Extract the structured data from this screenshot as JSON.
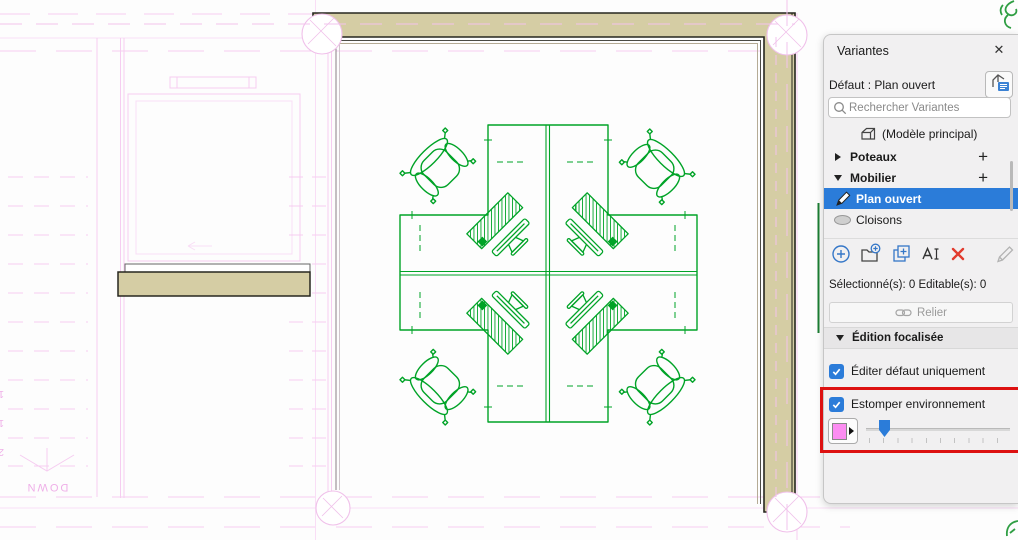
{
  "panel": {
    "title": "Variantes",
    "close_label": "✕",
    "default_line": "Défaut : Plan ouvert",
    "search_placeholder": "Rechercher Variantes",
    "main_model_label": "(Modèle principal)",
    "sets": [
      {
        "label": "Poteaux",
        "add_label": "+",
        "expanded": false
      },
      {
        "label": "Mobilier",
        "add_label": "+",
        "expanded": true
      }
    ],
    "options": [
      {
        "label": "Plan ouvert",
        "state": "selected-editing"
      },
      {
        "label": "Cloisons",
        "state": "hidden"
      }
    ],
    "status_line": "Sélectionné(s): 0 Editable(s): 0",
    "link_button_label": "Relier",
    "focused_edit_header": "Édition focalisée",
    "edit_default_label": "Éditer défaut uniquement",
    "fade_label": "Estomper environnement",
    "fade_slider_percent": 13,
    "icons": {
      "close": "x-glyph",
      "search": "magnifier",
      "transfer_default": "roof-with-list-badge",
      "main_model": "building",
      "set_collapsed": "triangle-right",
      "set_expanded": "triangle-down",
      "option_selected": "pencil",
      "option_hidden": "gray-ellipse",
      "toolbar": [
        "add-circle",
        "add-folder",
        "duplicate-plus",
        "rename-text",
        "delete-x",
        "edit-pencil"
      ],
      "link_button": "chain",
      "swatch_arrow": "triangle-right"
    },
    "colors": {
      "selected_row": "#2B7CD9",
      "checkbox_blue": "#2B7CD9",
      "delete_red": "#E23B2E",
      "swatch_pink": "#FC8DF2",
      "highlight_red": "#DD1111",
      "panel_bg": "#F1F0F1"
    }
  },
  "canvas": {
    "stair": {
      "down_label": "DOWN",
      "step_numbers": [
        "18",
        "19",
        "20"
      ]
    },
    "colors": {
      "furniture_green": "#00A327",
      "wall_fill": "#D5CDA4",
      "wall_outline": "#26261E",
      "faded_environment_pink": "#F5C9F0",
      "tree_green": "#2F9E43"
    }
  }
}
